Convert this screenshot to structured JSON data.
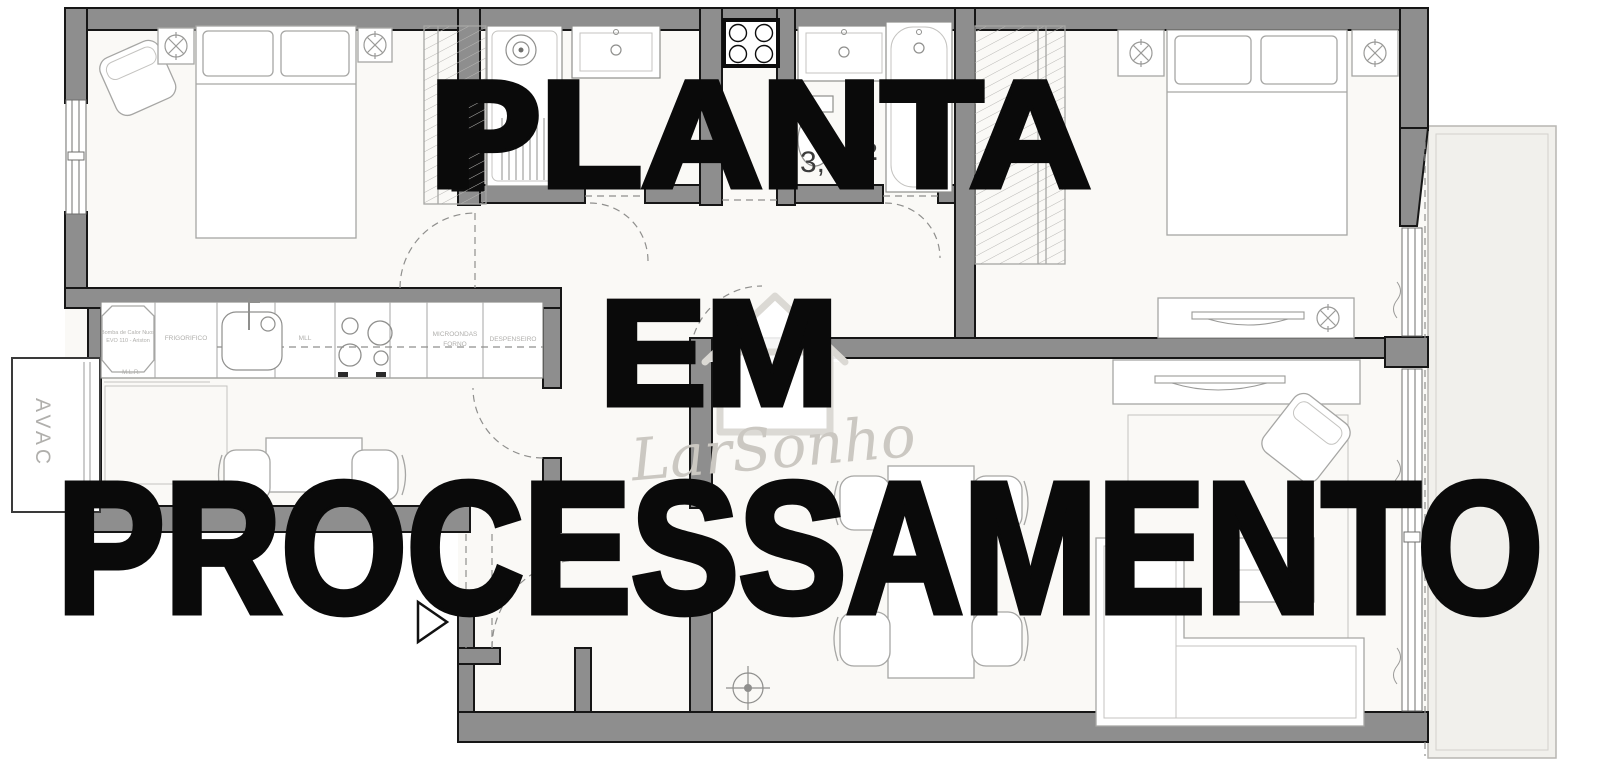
{
  "watermark": {
    "line1": "PLANTA",
    "line2": "EM",
    "line3": "PROCESSAMENTO",
    "color": "#0a0a0a"
  },
  "logo": {
    "text": "LarSonho",
    "color": "#cbc8c2"
  },
  "avac": {
    "label": "AVAC"
  },
  "kitchen": {
    "heat_pump_line1": "Bomba de Calor Nuos",
    "heat_pump_line2": "EVO 110 - Ariston",
    "fridge": "FRIGORIFICO",
    "dishwasher": "MLL",
    "microwave_line1": "MICROONDAS",
    "microwave_line2": "FORNO",
    "pantry": "DESPENSEIRO",
    "washer": "M.L.R."
  },
  "dimensions": {
    "fragment1": "3,",
    "fragment2": "2"
  },
  "colors": {
    "wall": "#8e8e8e",
    "wall_outline": "#161616",
    "floor": "#faf9f6",
    "balcony": "#f1f0ec",
    "furniture_line": "#a6a6a4",
    "watermark": "#0a0a0a",
    "logo_text": "#cbc8c2"
  }
}
